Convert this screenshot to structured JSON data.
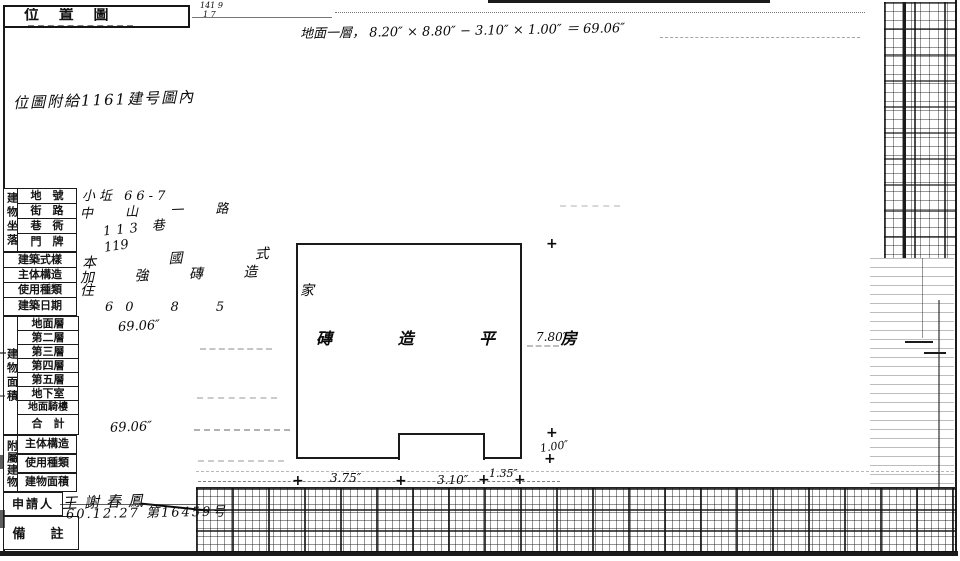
{
  "page": {
    "title": "位 置 圖",
    "title_note_line1": "141 9",
    "title_note_line2": "1 7",
    "margin_note": "位圖附給1161建号圖內",
    "area_formula": "地面一層， 8.20″ × 8.80″ − 3.10″ × 1.00″ ＝ 69.06″"
  },
  "table": {
    "location_group": "建物坐落",
    "location_rows": [
      {
        "label": "地　號",
        "value": "小坵 66-7"
      },
      {
        "label": "街　路",
        "value": "中 山 一 路"
      },
      {
        "label": "巷　衖",
        "value": "113 巷"
      },
      {
        "label": "門　牌",
        "value": "119"
      }
    ],
    "info_rows": [
      {
        "label": "建築式樣",
        "value": "本 國 式"
      },
      {
        "label": "主体構造",
        "value": "加 強 磚 造"
      },
      {
        "label": "使用種類",
        "value": "住　家"
      },
      {
        "label": "建築日期",
        "value": "60　8　5"
      }
    ],
    "area_group": "建物面積",
    "area_rows": [
      {
        "label": "地面層",
        "value": "69.06″"
      },
      {
        "label": "第二層",
        "value": ""
      },
      {
        "label": "第三層",
        "value": ""
      },
      {
        "label": "第四層",
        "value": ""
      },
      {
        "label": "第五層",
        "value": ""
      },
      {
        "label": "地下室",
        "value": ""
      },
      {
        "label": "地面騎樓",
        "value": ""
      },
      {
        "label": "合　計",
        "value": "69.06″"
      }
    ],
    "annex_group": "附屬建物",
    "annex_rows": [
      {
        "label": "主体構造",
        "value": ""
      },
      {
        "label": "使用種類",
        "value": ""
      },
      {
        "label": "建物面積",
        "value": ""
      }
    ],
    "applicant_label": "申請人",
    "applicant_value": "王謝春鳳",
    "remarks_label": "備　註",
    "remarks_value": "60.12.27 第16459号"
  },
  "drawing": {
    "building_text": "磚 造 平 房",
    "dim_right_height": "7.80″",
    "dim_right_notch": "1.00″",
    "dim_bottom_left": "3.75″",
    "dim_bottom_mid": "3.10″",
    "dim_bottom_right": "1.35″",
    "plus": "+"
  }
}
